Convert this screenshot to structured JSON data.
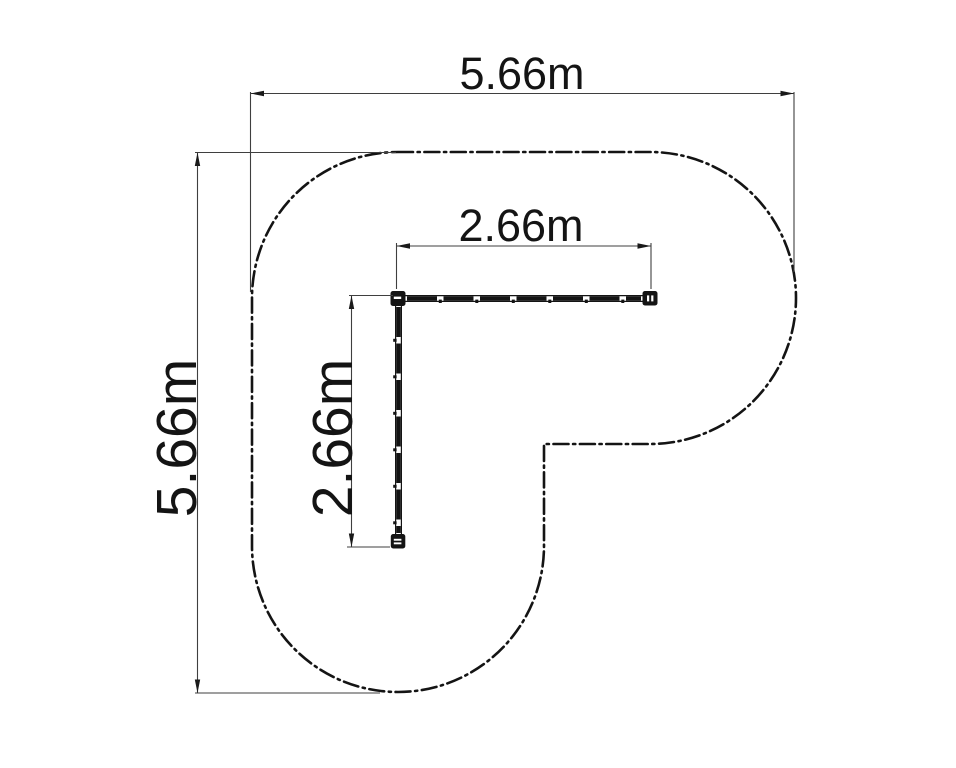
{
  "drawing": {
    "background": "#ffffff",
    "outline_color": "#141414",
    "dimension_line_color": "#3f3f3f",
    "boundary_line_style": "dash-dot",
    "dimensions": {
      "overall_width": {
        "label": "5.66m",
        "meters": 5.66
      },
      "overall_height": {
        "label": "5.66m",
        "meters": 5.66
      },
      "rail_top": {
        "label": "2.66m",
        "meters": 2.66
      },
      "rail_side": {
        "label": "2.66m",
        "meters": 2.66
      }
    }
  }
}
